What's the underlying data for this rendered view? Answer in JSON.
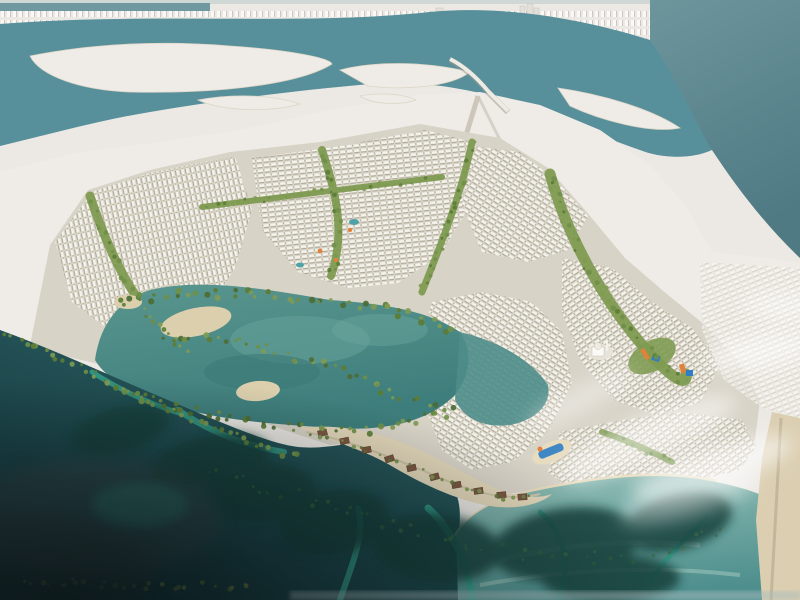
{
  "image": {
    "kind": "aerial-masterplan-rendering",
    "alt": "Aerial rendering of a coastal island masterplan: white city skyline across a teal channel at top, beige villa districts with green landscaped corridors in the middle, a mangrove lagoon with sandy beaches, a brown-roofed eco village on a sand spit, and dark mangrove waterways with bright channels at the bottom; soft white clouds drift over the beachfront villas",
    "palette": {
      "far_city": "#ece9e4",
      "city_building": "#f8f7f4",
      "city_shadow": "#c9c5be",
      "channel_water": "#58909b",
      "open_sea_top": "#6d959c",
      "open_sea_bottom": "#4f7a84",
      "island_white": "#efece7",
      "development_base": "#d8d3c7",
      "villa_roof": "#f3f1ec",
      "green_corridor": "#7f9b52",
      "tree_dark": "#5c7c36",
      "lagoon_water": "#4e8d8a",
      "lagoon_sand": "#dbcfad",
      "mangrove_green": "#6f8f48",
      "beach_sand": "#e3d7ba",
      "deep_water_top": "#2c5f62",
      "deep_water_bottom": "#0f2a2e",
      "bright_channel": "#35a28c",
      "shallow_sea": "#7fb3ad",
      "village_roof": "#7a5740",
      "waterpark_orange": "#e2813a",
      "waterpark_blue": "#2f7dc8",
      "cloud_white": "#ffffff",
      "haze_dark": "#2c3537"
    },
    "regions": [
      "far-city-skyline",
      "harbour-channel",
      "open-sea",
      "context-islands",
      "bridge",
      "context-mainland",
      "development-landmass",
      "villa-districts",
      "green-corridors",
      "waterpark-elements",
      "mosque",
      "mangrove-lagoon",
      "lagoon-beaches",
      "spit-village",
      "beach-club-pool",
      "deep-mangrove-water",
      "tidal-channels",
      "shallow-beach-sea",
      "coastal-sand-strip",
      "clouds",
      "corner-haze"
    ]
  }
}
